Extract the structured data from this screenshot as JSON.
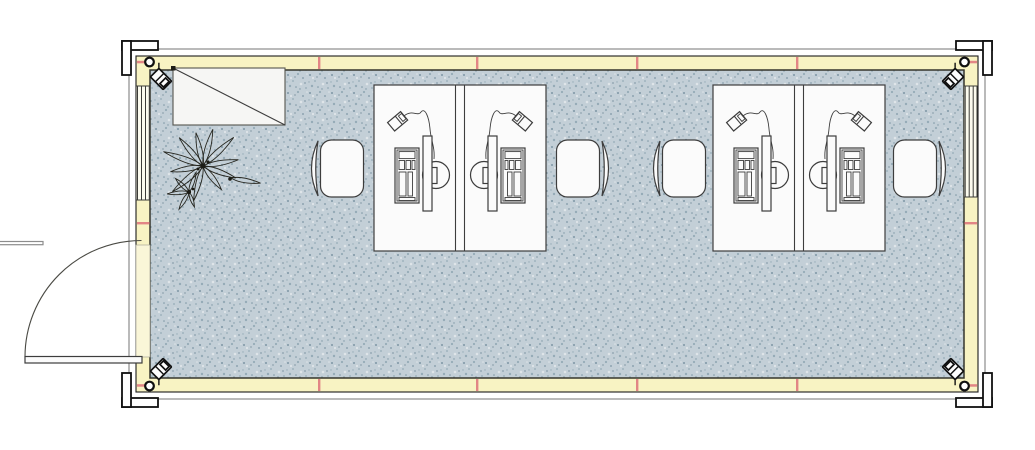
{
  "canvas": {
    "width": 1035,
    "height": 450,
    "background": "#ffffff"
  },
  "palette": {
    "floor_base": "#c3cfd7",
    "floor_speckle_dark": "#7e97a5",
    "floor_speckle_mid": "#95abb7",
    "floor_speckle_light": "#dfe5e9",
    "wall_fill": "#f8f3c3",
    "wall_inner_line": "#35352c",
    "band_fill": "#ffffff",
    "band_line": "#8d8d8d",
    "frame_line": "#1c1c1c",
    "joint_tick_red": "#e28585",
    "furniture_fill": "#fbfbfb",
    "furniture_line": "#3d3d3d",
    "door_panel_fill": "#faf6d8",
    "window_fill": "#fcfbee"
  },
  "plan": {
    "type": "office-container-floor-plan",
    "structure": {
      "corner_fittings": 4,
      "corner_mounted_devices": 4,
      "wall_joint_ticks_top": 4,
      "wall_joint_ticks_bottom": 4,
      "wall_joint_ticks_left": 1,
      "wall_joint_ticks_right": 1
    },
    "openings": {
      "door": {
        "wall": "left",
        "position": "lower",
        "swing": "outward",
        "state": "open-90deg"
      },
      "windows": [
        {
          "wall": "left",
          "position": "upper"
        },
        {
          "wall": "right",
          "position": "upper"
        }
      ]
    },
    "furniture": {
      "cabinet": {
        "count": 1,
        "location": "top-left",
        "symbol": "rectangle-with-diagonal"
      },
      "plant": {
        "count": 1,
        "location": "left"
      },
      "desk_clusters": {
        "count": 2,
        "workstations_per_cluster": 2,
        "divider": "double-line"
      },
      "workstation_items": [
        "keyboard-symbol",
        "flat-monitor-symbol",
        "monitor-stand-circle",
        "desk-lamp-symbol"
      ],
      "chairs": {
        "count": 4,
        "style": "rounded-seat-with-curved-backrest"
      }
    }
  }
}
